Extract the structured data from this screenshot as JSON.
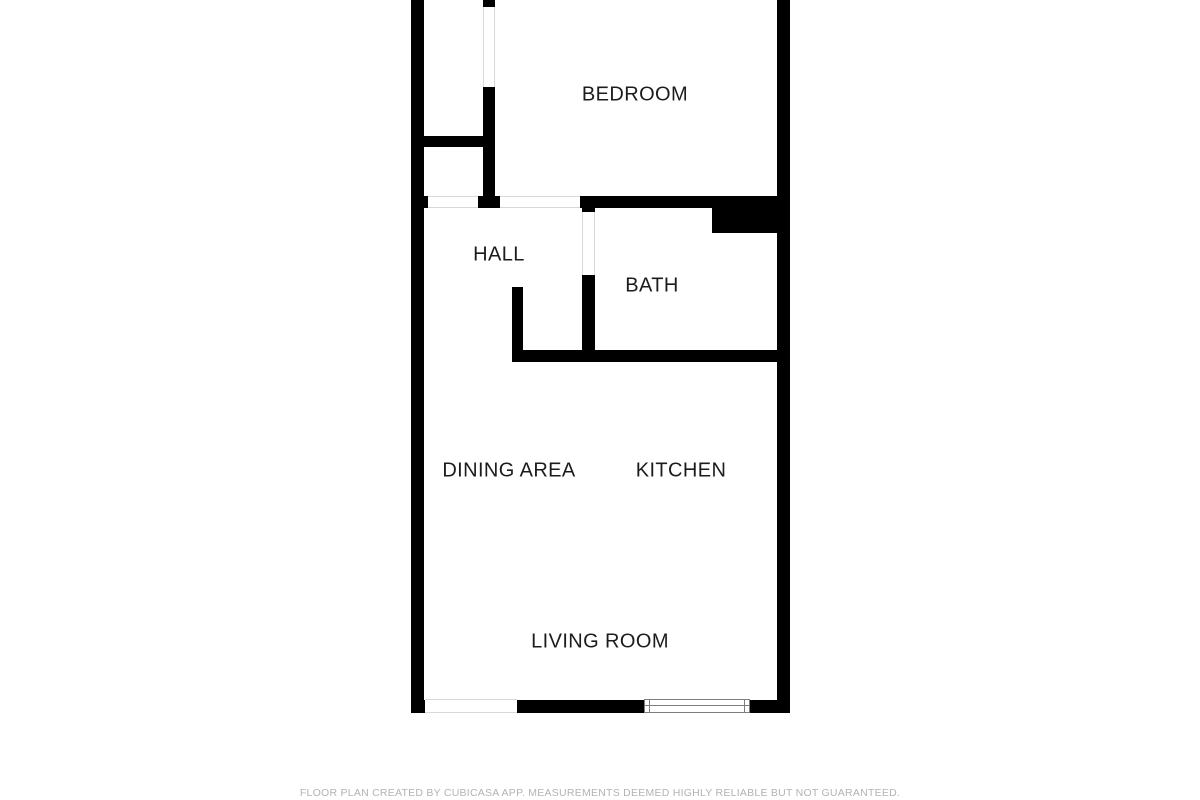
{
  "colors": {
    "background": "#ffffff",
    "wall": "#000000",
    "label_text": "#1c1c1c",
    "footer_text": "#b3b3b3",
    "opening_line": "#d8d8d8",
    "window_line": "#7d7d7d"
  },
  "footer": {
    "text": "FLOOR PLAN CREATED BY CUBICASA APP. MEASUREMENTS DEEMED HIGHLY RELIABLE BUT NOT GUARANTEED."
  },
  "plan": {
    "rooms": [
      {
        "id": "bedroom",
        "label": "BEDROOM",
        "cx": 635,
        "cy": 95
      },
      {
        "id": "hall",
        "label": "HALL",
        "cx": 499,
        "cy": 255
      },
      {
        "id": "bath",
        "label": "BATH",
        "cx": 652,
        "cy": 286
      },
      {
        "id": "dining-area",
        "label": "DINING AREA",
        "cx": 509,
        "cy": 471
      },
      {
        "id": "kitchen",
        "label": "KITCHEN",
        "cx": 681,
        "cy": 471
      },
      {
        "id": "living-room",
        "label": "LIVING ROOM",
        "cx": 600,
        "cy": 642
      }
    ],
    "walls": [
      {
        "name": "left-outer-wall",
        "x": 411,
        "y": 0,
        "w": 13,
        "h": 713
      },
      {
        "name": "right-outer-wall",
        "x": 777,
        "y": 0,
        "w": 13,
        "h": 713
      },
      {
        "name": "bottom-outer-wall",
        "x": 411,
        "y": 700,
        "w": 379,
        "h": 13
      },
      {
        "name": "bedroom-hall-bath-wall",
        "x": 411,
        "y": 196,
        "w": 379,
        "h": 12
      },
      {
        "name": "closet-wall-top-stub",
        "x": 483,
        "y": 0,
        "w": 12,
        "h": 7
      },
      {
        "name": "closet-wall",
        "x": 483,
        "y": 87,
        "w": 12,
        "h": 109
      },
      {
        "name": "closet-divider-wall",
        "x": 411,
        "y": 136,
        "w": 84,
        "h": 11
      },
      {
        "name": "hall-bath-wall",
        "x": 582,
        "y": 196,
        "w": 13,
        "h": 166
      },
      {
        "name": "kitchen-top-wall",
        "x": 512,
        "y": 350,
        "w": 278,
        "h": 12
      },
      {
        "name": "hall-stub-wall",
        "x": 512,
        "y": 287,
        "w": 11,
        "h": 63
      },
      {
        "name": "bath-shaft",
        "x": 712,
        "y": 207,
        "w": 65,
        "h": 26
      }
    ],
    "openings": [
      {
        "name": "door-opening-closet-hall",
        "x": 428,
        "y": 196,
        "w": 50,
        "h": 12,
        "dir": "h"
      },
      {
        "name": "door-opening-hall-bedroom",
        "x": 500,
        "y": 196,
        "w": 80,
        "h": 12,
        "dir": "h"
      },
      {
        "name": "door-opening-bedroom-closet",
        "x": 483,
        "y": 7,
        "w": 12,
        "h": 80,
        "dir": "v"
      },
      {
        "name": "door-opening-hall-bath",
        "x": 582,
        "y": 212,
        "w": 13,
        "h": 63,
        "dir": "v"
      },
      {
        "name": "opening-bottom-left",
        "x": 425,
        "y": 699,
        "w": 92,
        "h": 14,
        "dir": "h"
      }
    ],
    "windows": [
      {
        "name": "living-room-window",
        "x": 644,
        "y": 699,
        "w": 106,
        "h": 14
      }
    ]
  }
}
